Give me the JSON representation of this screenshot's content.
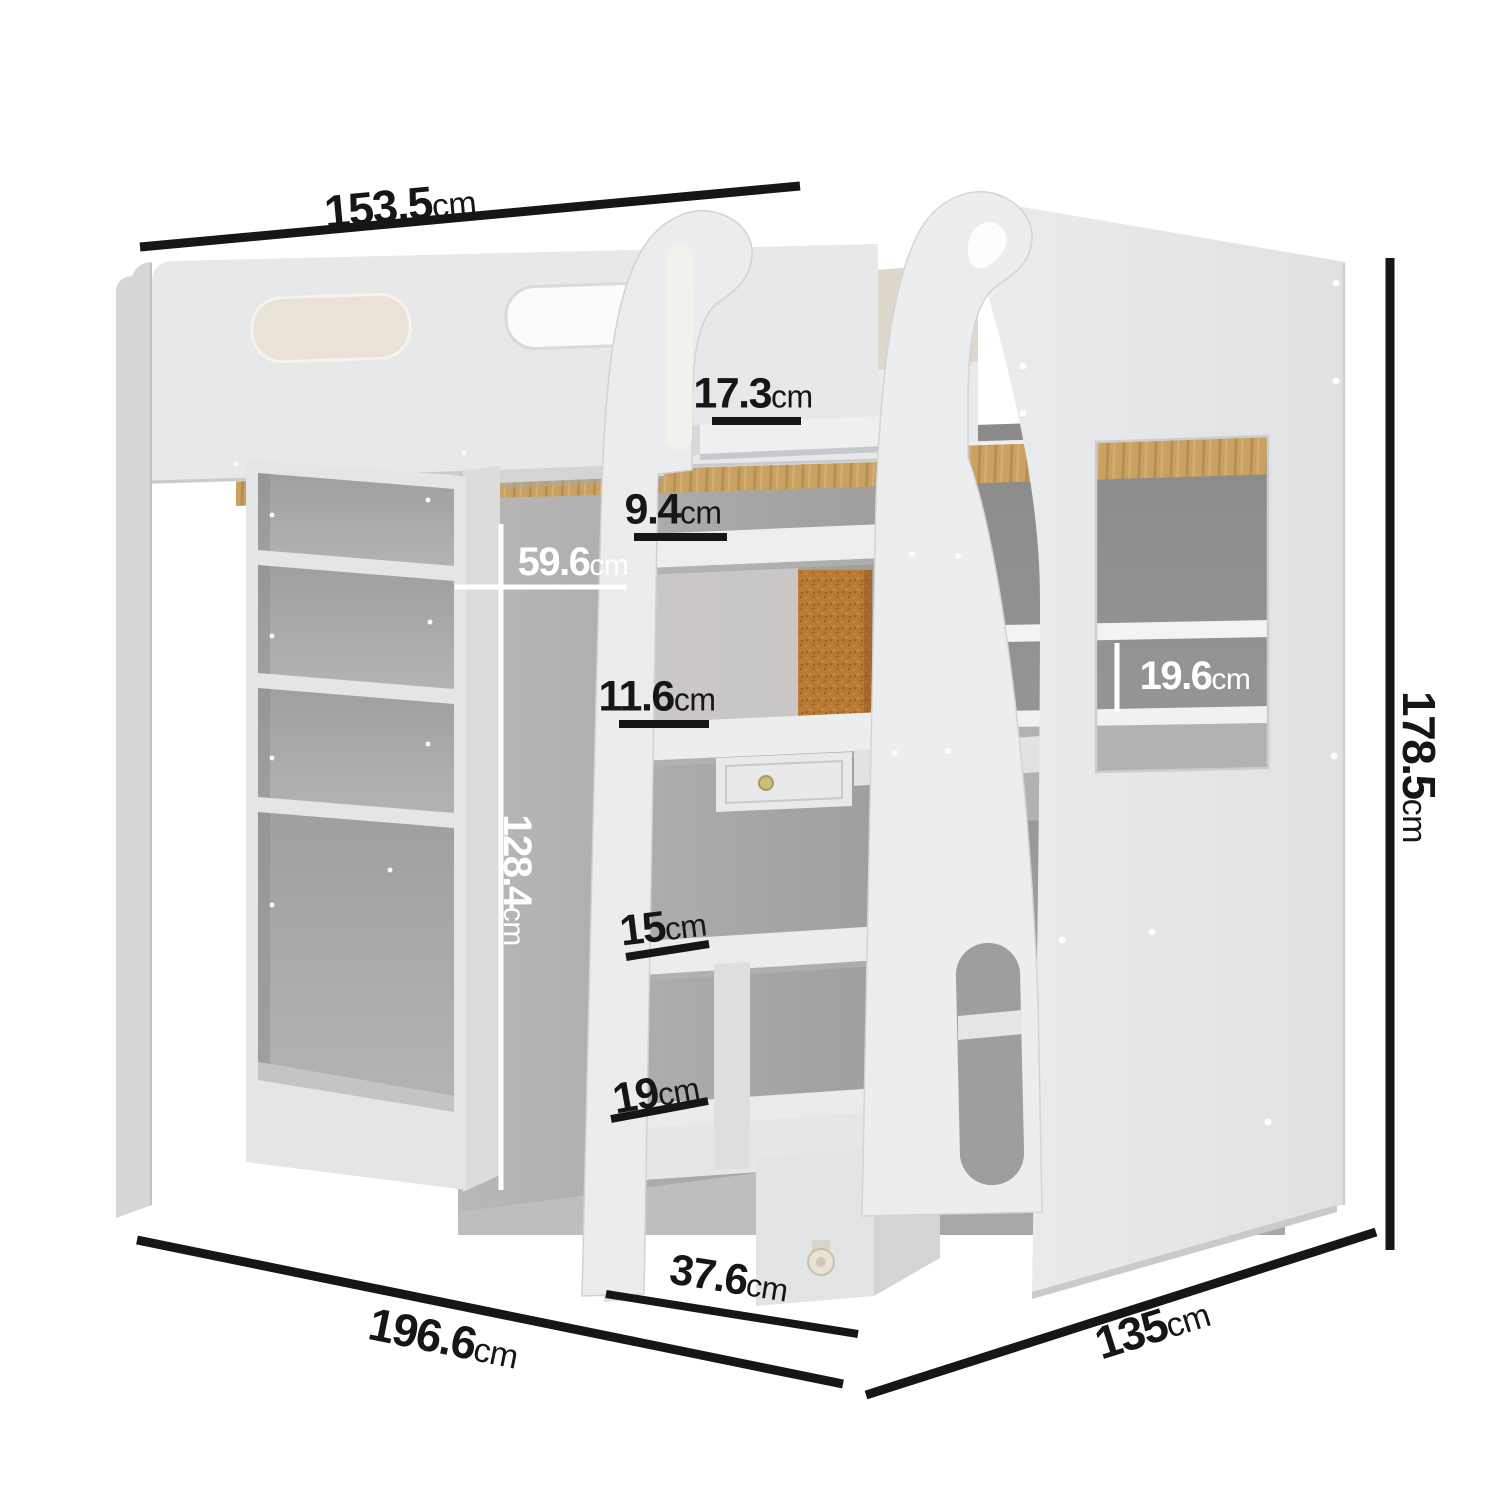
{
  "image": {
    "kind": "furniture dimension diagram",
    "subject": "white high sleeper loft bed with guard rails, hook-top ladder with storage steps, open wardrobe, bookcase shelving, desk with drawer, cork pinboard and caster wheel",
    "width_px": 1500,
    "height_px": 1500
  },
  "colors": {
    "background": "#ffffff",
    "dimension_line": "#161616",
    "dimension_text_light": "#ffffff",
    "panel": "#e6e8ea",
    "panel_dark": "#d4d6d8",
    "interior": "#a3a19f",
    "interior_dark": "#8f8d8b",
    "wood": "#c9a263",
    "wood_stripe": "#b78f4e",
    "cork": "#b97a33",
    "knob": "#cdbd77",
    "caster": "#e9e3d3"
  },
  "labels": [
    {
      "id": "overall-width-top",
      "number": "153.5",
      "unit": "cm"
    },
    {
      "id": "top-step-depth",
      "number": "17.3",
      "unit": "cm"
    },
    {
      "id": "second-step-depth",
      "number": "9.4",
      "unit": "cm"
    },
    {
      "id": "wardrobe-width",
      "number": "59.6",
      "unit": "cm"
    },
    {
      "id": "third-step-depth",
      "number": "11.6",
      "unit": "cm"
    },
    {
      "id": "wardrobe-height",
      "number": "128.4",
      "unit": "cm"
    },
    {
      "id": "side-cubby-height",
      "number": "19.6",
      "unit": "cm"
    },
    {
      "id": "shelf-space-15",
      "number": "15",
      "unit": "cm"
    },
    {
      "id": "shelf-space-19",
      "number": "19",
      "unit": "cm"
    },
    {
      "id": "storage-unit-depth",
      "number": "37.6",
      "unit": "cm"
    },
    {
      "id": "overall-depth",
      "number": "196.6",
      "unit": "cm"
    },
    {
      "id": "overall-width-end",
      "number": "135",
      "unit": "cm"
    },
    {
      "id": "overall-height",
      "number": "178.5",
      "unit": "cm"
    }
  ]
}
